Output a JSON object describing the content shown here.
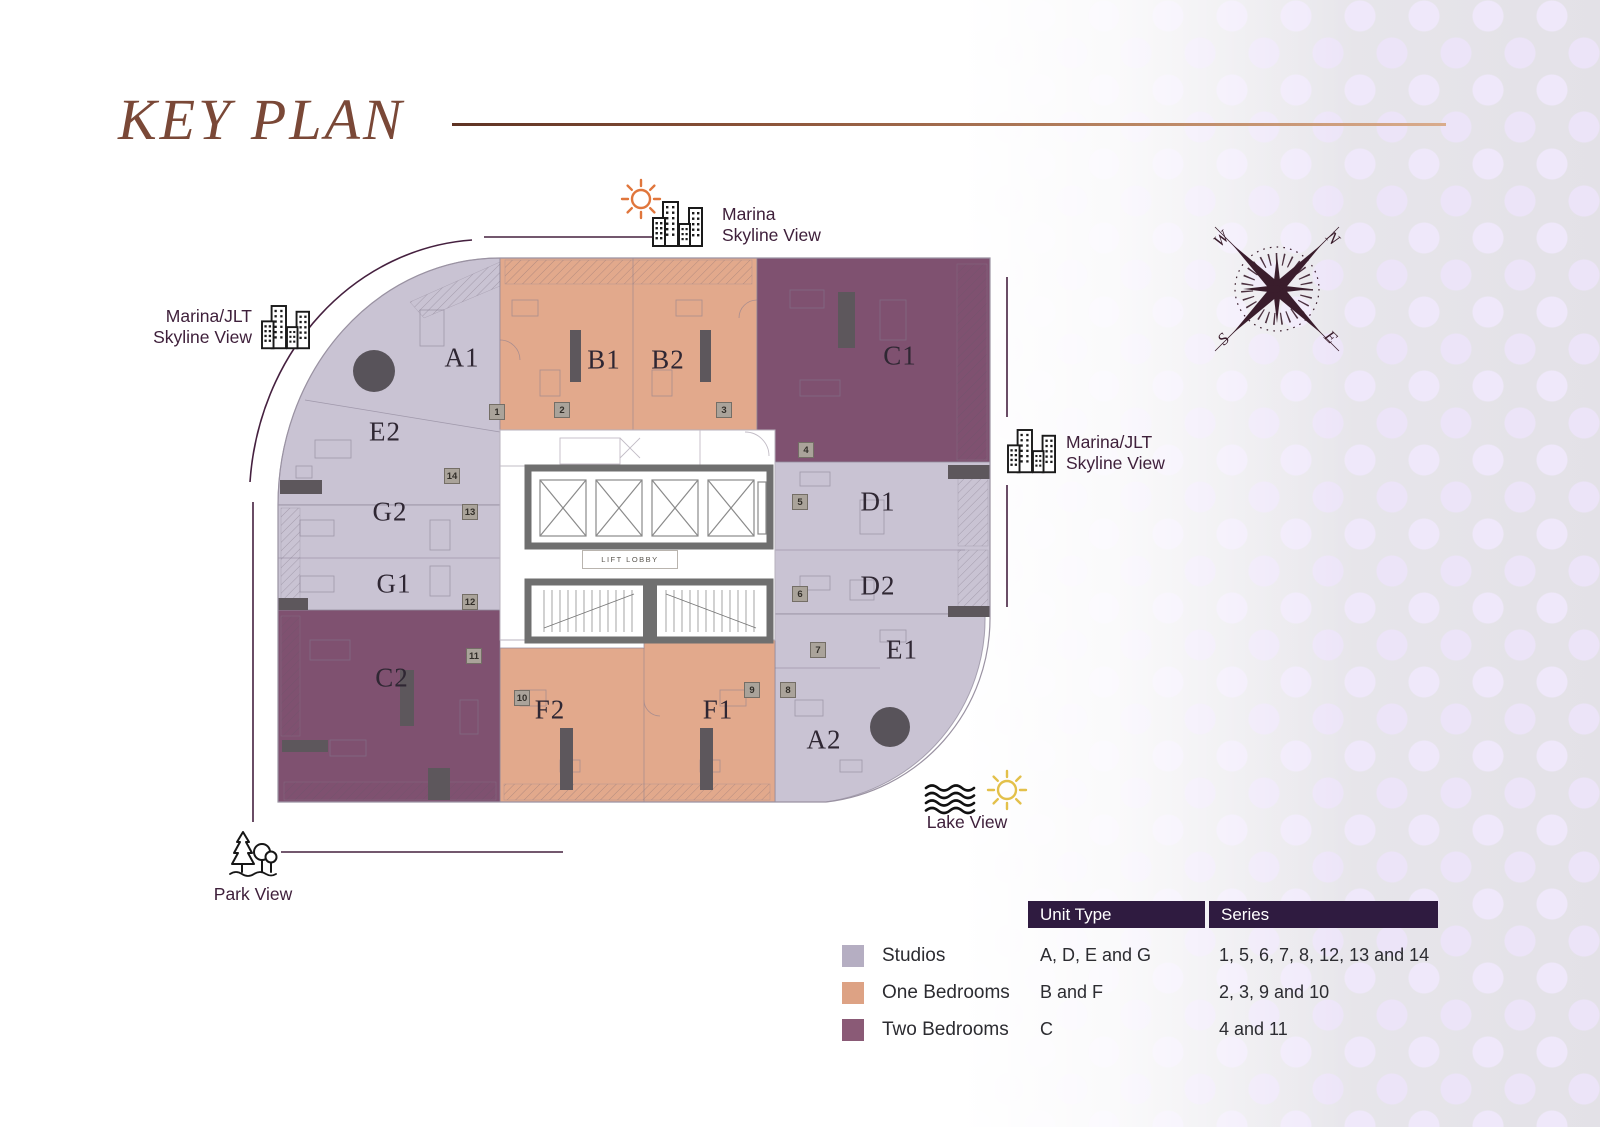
{
  "title": "KEY PLAN",
  "colors": {
    "studios": "#b5aec2",
    "one_bedrooms": "#dda284",
    "two_bedrooms": "#8a5a76",
    "studios_plan": "#c9c3d3",
    "one_bedrooms_plan": "#e2a98c",
    "two_bedrooms_plan": "#7f5170",
    "legend_header_bg": "#2f1b40",
    "title_text": "#7a4837",
    "guide": "#45203f",
    "compass": "#3a1d2c",
    "sun_orange": "#e0763c",
    "sun_yellow": "#e3c04a"
  },
  "views": {
    "top": {
      "line1": "Marina",
      "line2": "Skyline View"
    },
    "left": {
      "line1": "Marina/JLT",
      "line2": "Skyline View"
    },
    "right": {
      "line1": "Marina/JLT",
      "line2": "Skyline View"
    },
    "lake": {
      "label": "Lake View"
    },
    "park": {
      "label": "Park View"
    }
  },
  "compass": {
    "n": "N",
    "e": "E",
    "s": "S",
    "w": "W"
  },
  "plan": {
    "lift_lobby": "LIFT LOBBY",
    "unit_labels": [
      {
        "label": "A1",
        "x": 462,
        "y": 358
      },
      {
        "label": "B1",
        "x": 604,
        "y": 360
      },
      {
        "label": "B2",
        "x": 668,
        "y": 360
      },
      {
        "label": "C1",
        "x": 900,
        "y": 356
      },
      {
        "label": "E2",
        "x": 385,
        "y": 432
      },
      {
        "label": "G2",
        "x": 390,
        "y": 512
      },
      {
        "label": "G1",
        "x": 394,
        "y": 584
      },
      {
        "label": "C2",
        "x": 392,
        "y": 678
      },
      {
        "label": "F2",
        "x": 550,
        "y": 710
      },
      {
        "label": "F1",
        "x": 718,
        "y": 710
      },
      {
        "label": "A2",
        "x": 824,
        "y": 740
      },
      {
        "label": "E1",
        "x": 902,
        "y": 650
      },
      {
        "label": "D2",
        "x": 878,
        "y": 586
      },
      {
        "label": "D1",
        "x": 878,
        "y": 502
      }
    ],
    "series_badges": [
      {
        "label": "1",
        "x": 497,
        "y": 412
      },
      {
        "label": "2",
        "x": 562,
        "y": 410
      },
      {
        "label": "3",
        "x": 724,
        "y": 410
      },
      {
        "label": "4",
        "x": 806,
        "y": 450
      },
      {
        "label": "5",
        "x": 800,
        "y": 502
      },
      {
        "label": "6",
        "x": 800,
        "y": 594
      },
      {
        "label": "7",
        "x": 818,
        "y": 650
      },
      {
        "label": "8",
        "x": 788,
        "y": 690
      },
      {
        "label": "9",
        "x": 752,
        "y": 690
      },
      {
        "label": "10",
        "x": 522,
        "y": 698
      },
      {
        "label": "11",
        "x": 474,
        "y": 656
      },
      {
        "label": "12",
        "x": 470,
        "y": 602
      },
      {
        "label": "13",
        "x": 470,
        "y": 512
      },
      {
        "label": "14",
        "x": 452,
        "y": 476
      }
    ]
  },
  "legend": {
    "headers": [
      "Unit Type",
      "Series"
    ],
    "rows": [
      {
        "swatch_color": "#b5aec2",
        "label": "Studios",
        "unit_type": "A, D, E and G",
        "series": "1, 5, 6, 7, 8, 12, 13 and 14"
      },
      {
        "swatch_color": "#dda284",
        "label": "One Bedrooms",
        "unit_type": "B and F",
        "series": "2, 3, 9 and 10"
      },
      {
        "swatch_color": "#8a5a76",
        "label": "Two Bedrooms",
        "unit_type": "C",
        "series": "4 and 11"
      }
    ]
  }
}
